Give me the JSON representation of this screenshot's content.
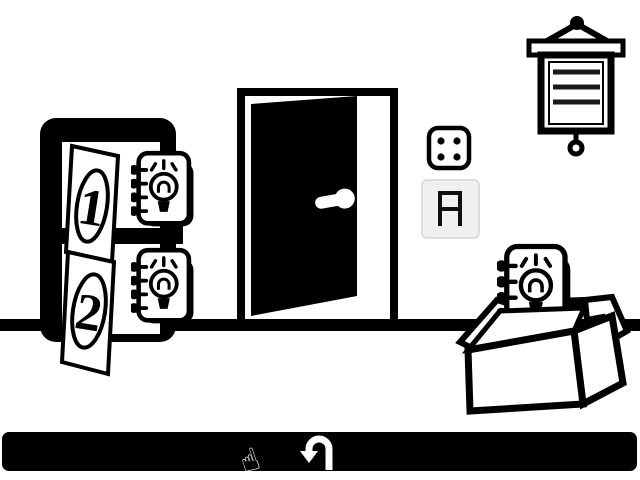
{
  "scene": {
    "background": "#ffffff",
    "ink": "#000000"
  },
  "wall_chart": {
    "icon": "hanging-chart-icon",
    "text_lines": "3"
  },
  "cabinet": {
    "doors": [
      {
        "label": "1"
      },
      {
        "label": "2"
      }
    ],
    "hint_icon": "lightbulb-notepad-icon"
  },
  "exit_door": {
    "icon": "open-door-icon"
  },
  "dice": {
    "value": "4",
    "icon": "die-face-4-icon"
  },
  "display": {
    "value": "A",
    "bg": "#f0f0f0",
    "border": "#d6d6d6",
    "segment_color": "#101010"
  },
  "box": {
    "icon": "open-box-icon",
    "hint_icon": "lightbulb-notepad-icon"
  },
  "toolbar": {
    "bg": "#000000",
    "undo_icon": "u-turn-arrow-icon",
    "pointer_glyph": "☝"
  }
}
